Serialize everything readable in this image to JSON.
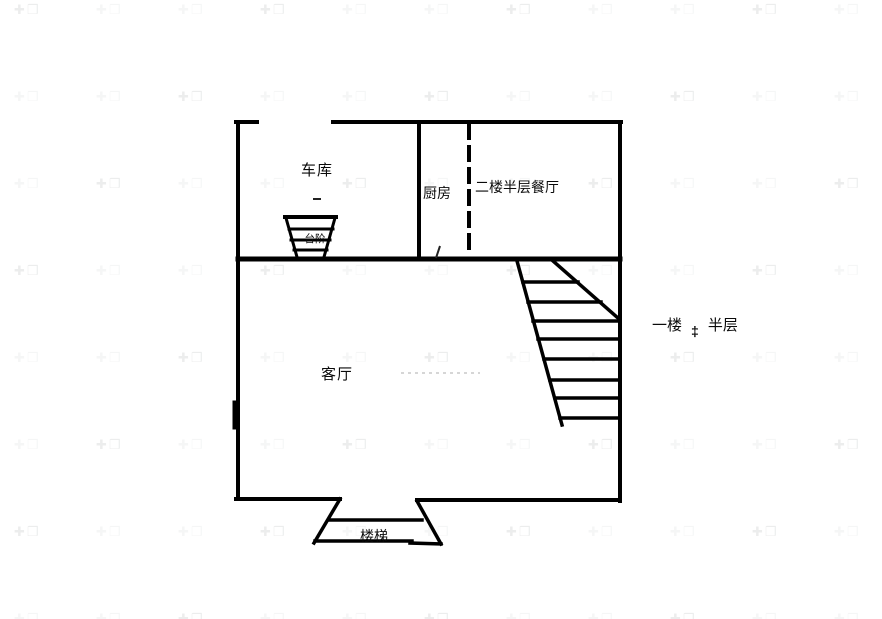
{
  "page": {
    "background": "#ffffff",
    "line_color": "#000000",
    "faint_line_color": "#c9c9c9"
  },
  "labels": {
    "garage": "车库",
    "kitchen": "厨房",
    "dining": "二楼半层餐厅",
    "living_room": "客厅",
    "first_floor": "一楼",
    "level_symbol": "‡",
    "half_level": "半层",
    "stairs": "楼梯",
    "steps": "台阶"
  },
  "watermark": {
    "glyph": "✚❒"
  }
}
